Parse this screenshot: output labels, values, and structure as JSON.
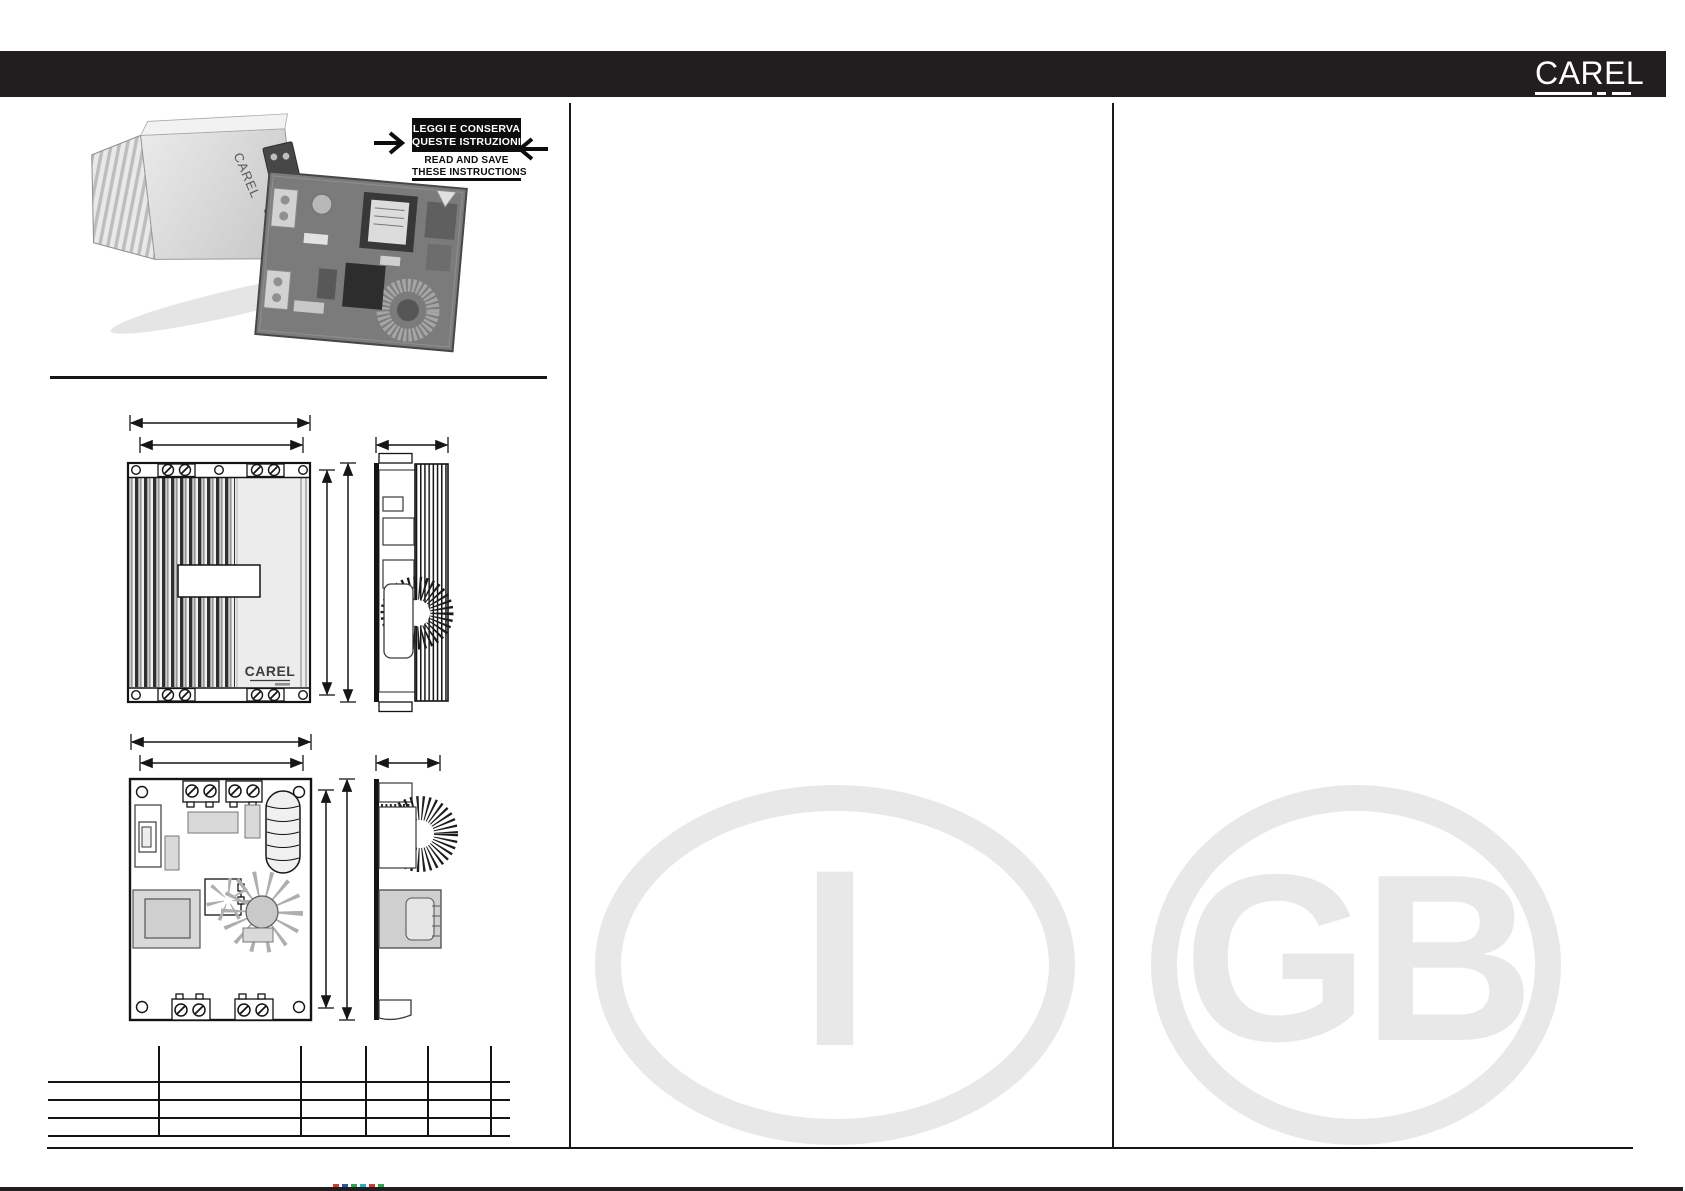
{
  "header": {
    "logo_text": "CAREL",
    "bar_color": "#221e1f"
  },
  "instruction_notice": {
    "italian_line1": "LEGGI E CONSERVA",
    "italian_line2": "QUESTE ISTRUZIONI",
    "english_line1": "READ AND SAVE",
    "english_line2": "THESE INSTRUCTIONS"
  },
  "photos": {
    "device_label": "CAREL"
  },
  "drawings": {
    "front_view_label": "CAREL"
  },
  "watermarks": {
    "italian_label": "I",
    "english_label": "GB",
    "color": "#e8e8e9"
  },
  "spec_table": {
    "columns": 6,
    "rows": 4,
    "visible_text": ""
  },
  "footer": {
    "bar_color": "#221e1f",
    "registration_mark_colors": [
      "#d23b2e",
      "#2e54a8",
      "#2ea84c",
      "#18b7c9",
      "#d23b2e",
      "#2ea84c"
    ]
  }
}
